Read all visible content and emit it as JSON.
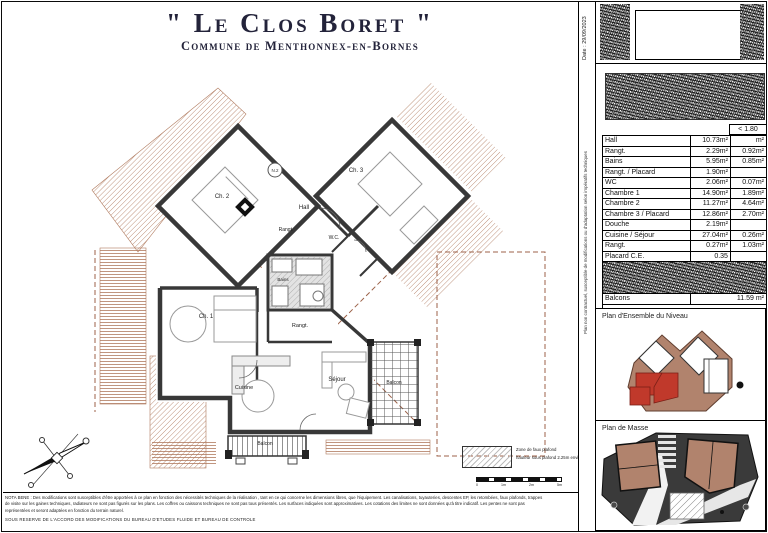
{
  "title": {
    "main": "\" Le Clos Boret \"",
    "subtitle": "Commune de Menthonnex-en-Bornes"
  },
  "meta": {
    "date_label": "Date : 29/09/2023",
    "side_note": "Plan non contractuel, susceptible de modifications ou d'adaptation selon impératifs techniques"
  },
  "area_table": {
    "header_right": "< 1.80",
    "rows": [
      {
        "label": "Hall",
        "main": "10.73m²",
        "right": "m²"
      },
      {
        "label": "Rangt.",
        "main": "2.29m²",
        "right": "0.92m²"
      },
      {
        "label": "Bains",
        "main": "5.95m²",
        "right": "0.85m²"
      },
      {
        "label": "Rangt. / Placard",
        "main": "1.90m²",
        "right": ""
      },
      {
        "label": "WC",
        "main": "2.06m²",
        "right": "0.07m²"
      },
      {
        "label": "Chambre 1",
        "main": "14.90m²",
        "right": "1.89m²"
      },
      {
        "label": "Chambre 2",
        "main": "11.27m²",
        "right": "4.64m²"
      },
      {
        "label": "Chambre 3 / Placard",
        "main": "12.86m²",
        "right": "2.70m²"
      },
      {
        "label": "Douche",
        "main": "2.19m²",
        "right": ""
      },
      {
        "label": "Cuisine / Séjour",
        "main": "27.04m²",
        "right": "0.26m²"
      },
      {
        "label": "Rangt.",
        "main": "0.27m²",
        "right": "1.03m²"
      },
      {
        "label": "Placard C.E.",
        "main": "0.35",
        "right": ""
      }
    ],
    "balcons_row": {
      "label": "Balcons",
      "value": "11.59 m²"
    }
  },
  "panels": {
    "ensemble_title": "Plan d'Ensemble du Niveau",
    "masse_title": "Plan de Masse"
  },
  "plan": {
    "unit_badge": "N.2",
    "rooms": {
      "ch1": "Ch. 1",
      "ch2": "Ch. 2",
      "ch3": "Ch. 3",
      "hall": "Hall",
      "wc": "W.C.",
      "rangt_a": "Rangt.",
      "rangt_b": "Rangt.",
      "bains": "Bains",
      "cuisine": "Cuisine",
      "sejour": "Séjour",
      "balcon_right": "Balcon",
      "balcon_bottom": "Balcon"
    }
  },
  "legend": {
    "line1": "Zone de faux plafond",
    "line2": "hauteur sous plafond 2.25m environ"
  },
  "scale": {
    "ticks": [
      "0",
      "1m",
      "2m",
      "5m"
    ]
  },
  "footer": {
    "line1": "NOTA BENE : Des modifications sont susceptibles d'être apportées à ce plan en fonction des nécessités techniques de la réalisation , tant en ce qui concerne les dimensions libres, que l'équipement. Les canalisations, tuyauteries, descentes EP, les retombées, faux plafonds, trappes",
    "line2": "de visite sur les gaines techniques, radiateurs ne sont pas figurés sur les plans. Les coffres ou caissons techniques ne sont pas tous présentés. Les surfaces indiquées sont approximatives. Les cotations des limites ne sont données qu'à titre indicatif. Les pentes ne sont pas",
    "line3": "représentées et seront adaptées en fonction du terrain naturel.",
    "line4": "SOUS RESERVE DE L'ACCORD DES MODIFICATIONS DU BUREAU D'ETUDES FLUIDE ET BUREAU DE CONTROLE"
  },
  "colors": {
    "wall": "#383838",
    "roof_sepia": "#a5705a",
    "highlight_red": "#c0392b",
    "title_ink": "#23233a"
  }
}
